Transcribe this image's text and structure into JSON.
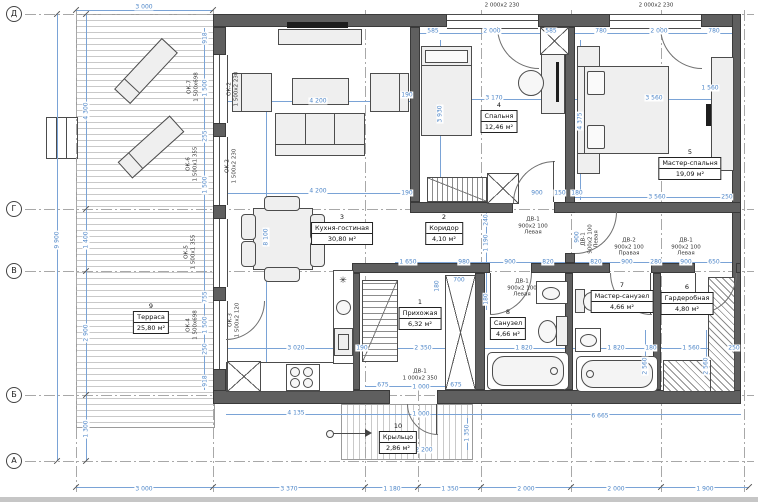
{
  "axes": {
    "row_labels": [
      "Д",
      "Г",
      "В",
      "Б",
      "А"
    ]
  },
  "rooms": [
    {
      "num": "1",
      "name": "Прихожая",
      "area": "6,32 м²"
    },
    {
      "num": "2",
      "name": "Коридор",
      "area": "4,10 м²"
    },
    {
      "num": "3",
      "name": "Кухня-гостиная",
      "area": "30,80 м²"
    },
    {
      "num": "4",
      "name": "Спальня",
      "area": "12,46 м²"
    },
    {
      "num": "5",
      "name": "Мастер-спальня",
      "area": "19,09 м²"
    },
    {
      "num": "6",
      "name": "Гардеробная",
      "area": "4,80 м²"
    },
    {
      "num": "7",
      "name": "Мастер-санузел",
      "area": "4,66 м²"
    },
    {
      "num": "8",
      "name": "Санузел",
      "area": "4,66 м²"
    },
    {
      "num": "9",
      "name": "Терраса",
      "area": "25,80 м²"
    },
    {
      "num": "10",
      "name": "Крыльцо",
      "area": "2,86 м²"
    }
  ],
  "window_labels": [
    {
      "id": "ОК-1",
      "size": "2 000х2 230"
    },
    {
      "id": "ОК-1",
      "size": "2 000х2 230"
    },
    {
      "id": "ОК-7",
      "size": "1 500х698"
    },
    {
      "id": "ОК-2",
      "size": "1 500х2 230"
    },
    {
      "id": "ОК-6",
      "size": "1 500х1 355"
    },
    {
      "id": "ОК-2",
      "size": "1 500х2 230"
    },
    {
      "id": "ОК-5",
      "size": "1 500х1 355"
    },
    {
      "id": "ОК-4",
      "size": "1 500х698"
    },
    {
      "id": "ОК-3",
      "size": "1 500х2 120"
    }
  ],
  "door_labels": [
    {
      "id": "ДВ-1",
      "size": "900х2 100",
      "hand": "Левая"
    },
    {
      "id": "ДВ-1",
      "size": "900х2 100",
      "hand": "Левая"
    },
    {
      "id": "ДВ-2",
      "size": "900х2 100",
      "hand": "Правая"
    },
    {
      "id": "ДВ-1",
      "size": "900х2 100",
      "hand": "Левая"
    },
    {
      "id": "ДВ-1",
      "size": "900х2 100",
      "hand": "Левая"
    },
    {
      "id": "ДВ-1",
      "size": "1 000х2 350",
      "hand": ""
    }
  ],
  "dims": [
    "3 000",
    "585",
    "2 000",
    "585",
    "780",
    "2 000",
    "780",
    "9 900",
    "4 300",
    "1 400",
    "2 900",
    "1 300",
    "918",
    "1 500",
    "255",
    "1 500",
    "755",
    "1 500",
    "250",
    "918",
    "4 200",
    "190",
    "4 200",
    "8 100",
    "3 170",
    "3 930",
    "3 560",
    "1 560",
    "4 375",
    "190",
    "900",
    "150",
    "180",
    "3 560",
    "250",
    "240",
    "1 190",
    "180",
    "900",
    "1 650",
    "980",
    "900",
    "820",
    "820",
    "900",
    "280",
    "900",
    "650",
    "700",
    "180",
    "3 020",
    "190",
    "2 350",
    "1 820",
    "1 820",
    "180",
    "1 560",
    "250",
    "2 560",
    "2 560",
    "675",
    "1 000",
    "675",
    "4 135",
    "1 000",
    "6 665",
    "2 200",
    "1 350",
    "3 000",
    "3 370",
    "1 180",
    "1 350",
    "2 000",
    "2 000",
    "1 900"
  ]
}
